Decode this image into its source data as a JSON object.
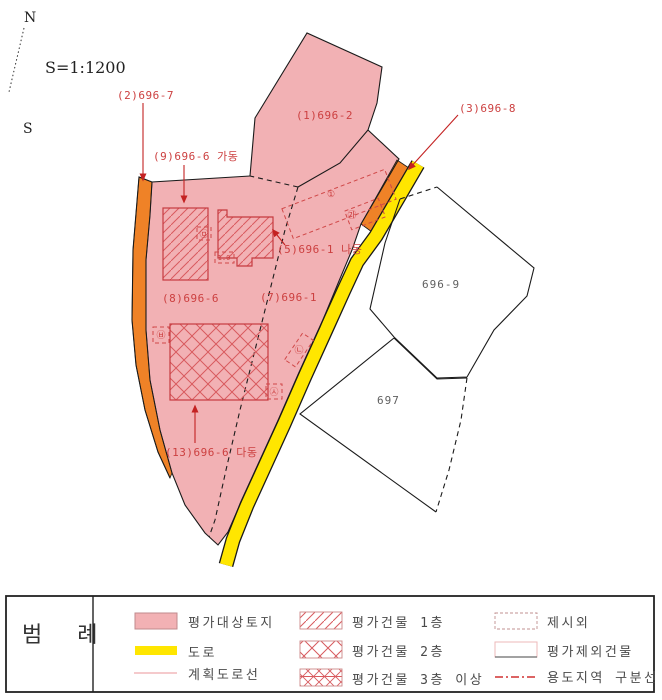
{
  "compass": {
    "north": "N",
    "south": "S",
    "scale": "S=1:1200"
  },
  "map": {
    "parcels": {
      "p2_696_7": "(2)696-7",
      "p9_696_6_ga": "(9)696-6 가동",
      "p1_696_2": "(1)696-2",
      "p3_696_8": "(3)696-8",
      "p5_696_1_na": "(5)696-1 나동",
      "p8_696_6": "(8)696-6",
      "p7_696_1": "(7)696-1",
      "p13_696_6_da": "(13)696-6 다동",
      "p696_9": "696-9",
      "p697": "697"
    },
    "markers": {
      "m1": "㉤",
      "m2": "1.0",
      "m3": "①",
      "m4": "㉮",
      "m5": "㉥",
      "m6": "㉦",
      "m7": "㉡"
    }
  },
  "legend": {
    "title": "범 례",
    "items": [
      {
        "label": "평가대상토지"
      },
      {
        "label": "도로"
      },
      {
        "label": "계획도로선"
      },
      {
        "label": "평가건물 1층"
      },
      {
        "label": "평가건물 2층"
      },
      {
        "label": "평가건물 3층 이상"
      },
      {
        "label": "제시외"
      },
      {
        "label": "평가제외건물"
      },
      {
        "label": "용도지역 구분선"
      }
    ]
  },
  "colors": {
    "target_land_pink": "#F2B1B4",
    "road_yellow": "#FFE600",
    "strip_orange": "#EF8227",
    "annotation_red": "#CC4040",
    "hatch_red": "#D85A5E",
    "boundary_black": "#1A1A1A",
    "excluded_white": "#FFFFFF"
  }
}
